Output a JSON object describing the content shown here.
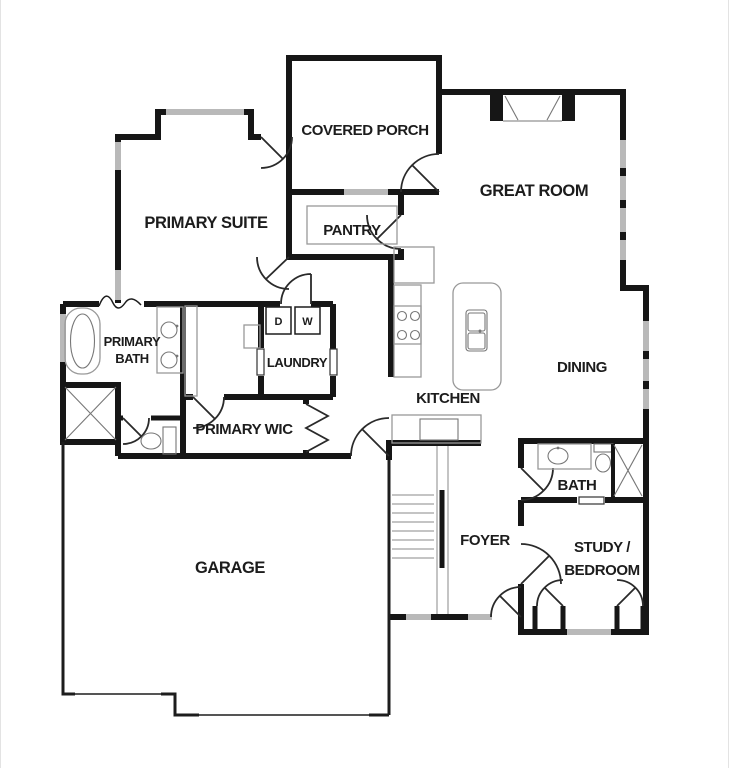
{
  "plan": {
    "type": "residential-floor-plan",
    "colors": {
      "background": "#ffffff",
      "wall": "#161616",
      "window": "#b9b9b9",
      "fixture_line": "#999999",
      "door_line": "#2a2a2a",
      "text": "#1c1c1c"
    },
    "labels": {
      "covered_porch": "COVERED PORCH",
      "great_room": "GREAT ROOM",
      "primary_suite": "PRIMARY SUITE",
      "pantry": "PANTRY",
      "dining": "DINING",
      "kitchen": "KITCHEN",
      "laundry": "LAUNDRY",
      "dryer": "D",
      "washer": "W",
      "primary_bath_line1": "PRIMARY",
      "primary_bath_line2": "BATH",
      "primary_wic": "PRIMARY WIC",
      "bath": "BATH",
      "foyer": "FOYER",
      "study_bedroom_line1": "STUDY /",
      "study_bedroom_line2": "BEDROOM",
      "garage": "GARAGE"
    }
  }
}
